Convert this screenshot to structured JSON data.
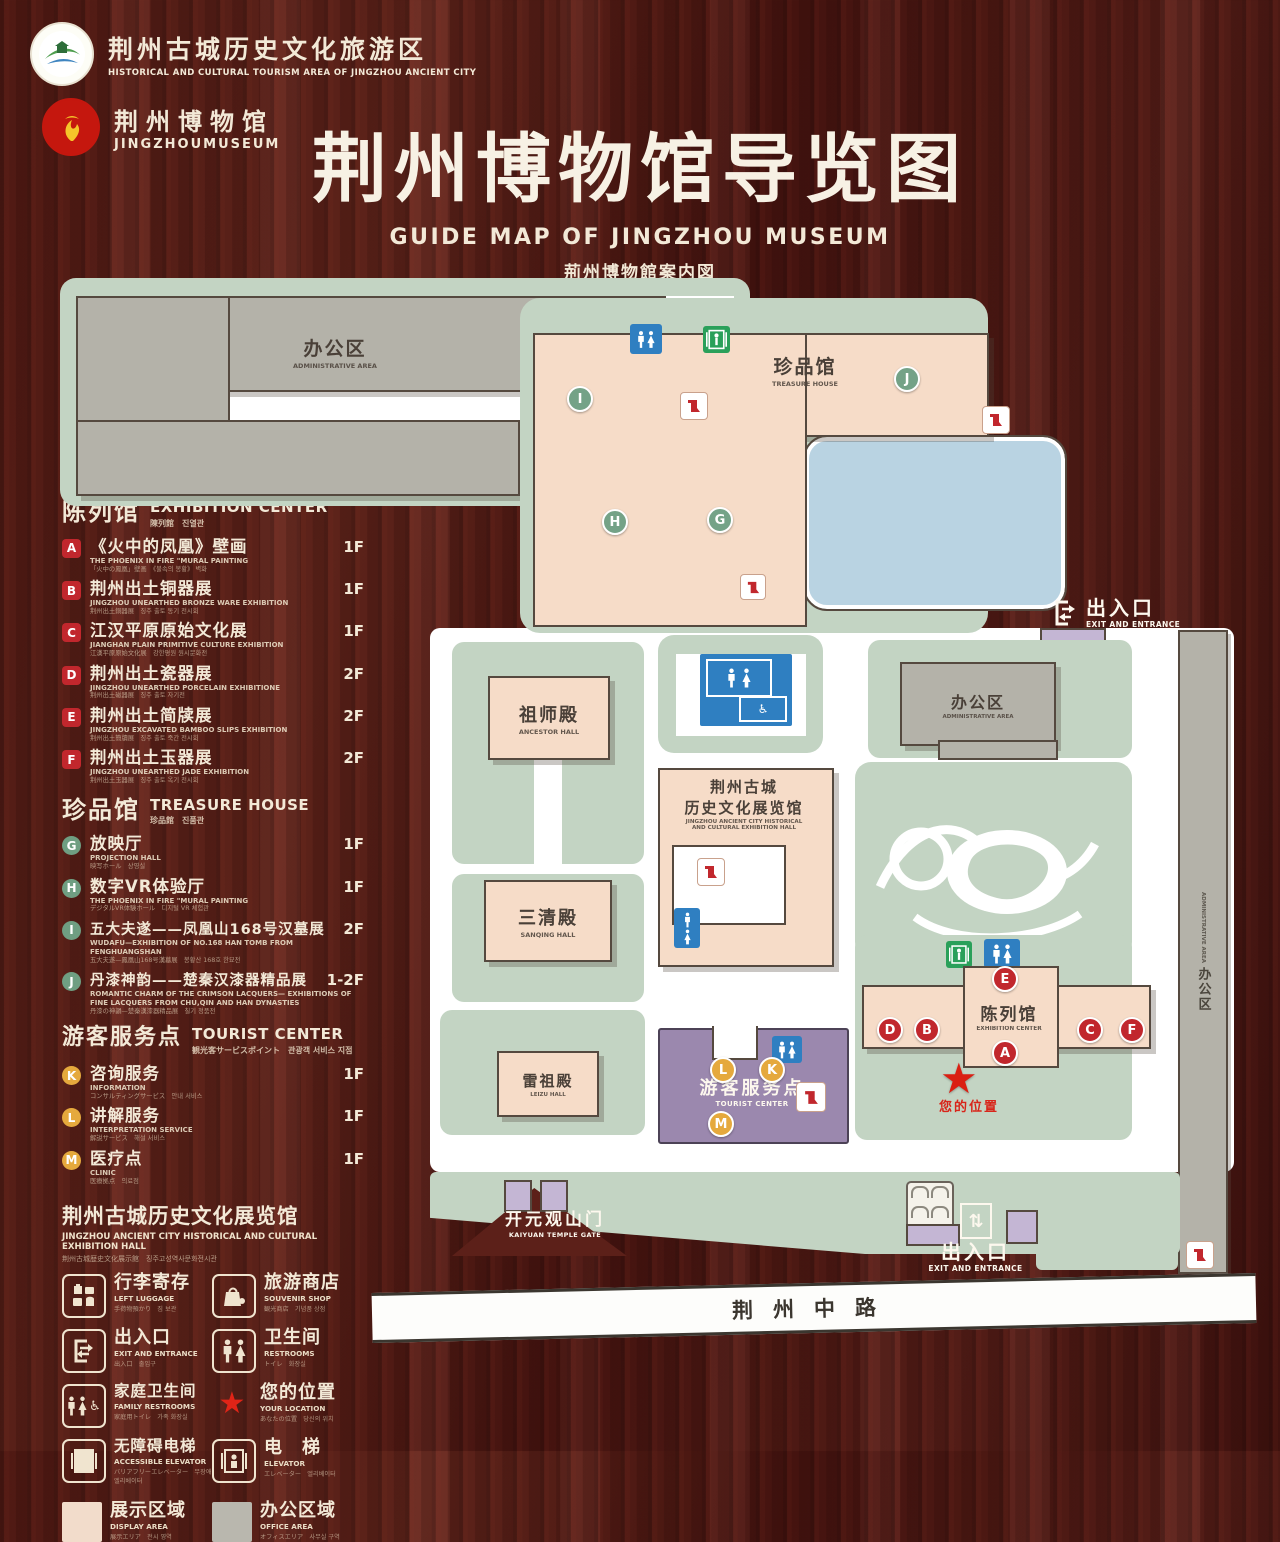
{
  "header": {
    "logo1": {
      "title": "荆州古城历史文化旅游区",
      "subtitle": "HISTORICAL AND CULTURAL TOURISM AREA OF JINGZHOU ANCIENT CITY"
    },
    "logo2": {
      "title": "荆州博物馆",
      "subtitle": "JINGZHOUMUSEUM"
    },
    "title": "荆州博物馆导览图",
    "subtitle_en": "GUIDE MAP OF JINGZHOU MUSEUM",
    "subtitle_ja": "荊州博物館案内図",
    "subtitle_ko": "징주박물관 안내도"
  },
  "legend": {
    "sections": [
      {
        "zh": "陈列馆",
        "en": "EXHIBITION CENTER",
        "sub": "陳列館　진열관",
        "items": [
          {
            "key": "A",
            "zh": "《火中的凤凰》壁画",
            "en": "THE PHOENIX IN FIRE \"MURAL PAINTING",
            "sub": "「火中の鳳凰」壁画　《불속의 봉황》 벽화",
            "floor": "1F"
          },
          {
            "key": "B",
            "zh": "荆州出土铜器展",
            "en": "JINGZHOU UNEARTHED BRONZE WARE EXHIBITION",
            "sub": "荆州出土銅器展　징주 출토 동기 전시회",
            "floor": "1F"
          },
          {
            "key": "C",
            "zh": "江汉平原原始文化展",
            "en": "JIANGHAN PLAIN PRIMITIVE CULTURE EXHIBITION",
            "sub": "江漢平原原始文化展　강한평원 원시문화전",
            "floor": "1F"
          },
          {
            "key": "D",
            "zh": "荆州出土瓷器展",
            "en": "JINGZHOU UNEARTHED PORCELAIN EXHIBITIONE",
            "sub": "荆州出土磁器展　징주 출토 자기전",
            "floor": "2F"
          },
          {
            "key": "E",
            "zh": "荆州出土简牍展",
            "en": "JINGZHOU EXCAVATED BAMBOO SLIPS EXHIBITION",
            "sub": "荆州出土簡牘展　징주 출토 죽간 전시회",
            "floor": "2F"
          },
          {
            "key": "F",
            "zh": "荆州出土玉器展",
            "en": "JINGZHOU UNEARTHED JADE EXHIBITION",
            "sub": "荆州出土玉器展　징주 출토 옥기 전시회",
            "floor": "2F"
          }
        ]
      },
      {
        "zh": "珍品馆",
        "en": "TREASURE HOUSE",
        "sub": "珍品館　진품관",
        "items": [
          {
            "key": "G",
            "zh": "放映厅",
            "en": "PROJECTION HALL",
            "sub": "映写ホール　상영실",
            "floor": "1F"
          },
          {
            "key": "H",
            "zh": "数字VR体验厅",
            "en": "THE PHOENIX IN FIRE \"MURAL PAINTING",
            "sub": "デジタルVR体験ホール　디지털 VR 체험관",
            "floor": "1F"
          },
          {
            "key": "I",
            "zh": "五大夫遂——凤凰山168号汉墓展",
            "en": "WUDAFU—EXHIBITION OF NO.168 HAN TOMB FROM FENGHUANGSHAN",
            "sub": "五大夫遂—鳳凰山168号漢墓展　봉황산 168호 한묘전",
            "floor": "2F"
          },
          {
            "key": "J",
            "zh": "丹漆神韵——楚秦汉漆器精品展",
            "en": "ROMANTIC CHARM OF THE CRIMSON LACQUERS— EXHIBITIONS OF FINE LACQUERS FROM CHU,QIN AND HAN DYNASTIES",
            "sub": "丹漆の神韻—楚秦漢漆器精品展　칠기 정품전",
            "floor": "1-2F"
          }
        ]
      },
      {
        "zh": "游客服务点",
        "en": "TOURIST CENTER",
        "sub": "観光客サービスポイント　관광객 서비스 지점",
        "items": [
          {
            "key": "K",
            "zh": "咨询服务",
            "en": "INFORMATION",
            "sub": "コンサルティングサービス　안내 서비스",
            "floor": "1F"
          },
          {
            "key": "L",
            "zh": "讲解服务",
            "en": "INTERPRETATION SERVICE",
            "sub": "解説サービス　해설 서비스",
            "floor": "1F"
          },
          {
            "key": "M",
            "zh": "医疗点",
            "en": "CLINIC",
            "sub": "医療拠点　의료점",
            "floor": "1F"
          }
        ]
      }
    ],
    "hall_heading": {
      "zh": "荆州古城历史文化展览馆",
      "en": "JINGZHOU ANCIENT CITY HISTORICAL AND CULTURAL EXHIBITION HALL",
      "sub": "荆州古城歴史文化展示館　징주고성역사문화전시관"
    },
    "pictos": [
      {
        "zh": "行李寄存",
        "en": "LEFT LUGGAGE",
        "sub": "手荷物預かり　짐 보관"
      },
      {
        "zh": "旅游商店",
        "en": "SOUVENIR SHOP",
        "sub": "観光商店　기념품 상점"
      },
      {
        "zh": "出入口",
        "en": "EXIT AND ENTRANCE",
        "sub": "出入口　출입구"
      },
      {
        "zh": "卫生间",
        "en": "RESTROOMS",
        "sub": "トイレ　화장실"
      },
      {
        "zh": "家庭卫生间",
        "en": "FAMILY RESTROOMS",
        "sub": "家庭用トイレ　가족 화장실"
      },
      {
        "zh": "您的位置",
        "en": "YOUR LOCATION",
        "sub": "あなたの位置　당신의 위치"
      },
      {
        "zh": "无障碍电梯",
        "en": "ACCESSIBLE ELEVATOR",
        "sub": "バリアフリーエレベーター　무장애 엘리베이터"
      },
      {
        "zh": "电　梯",
        "en": "ELEVATOR",
        "sub": "エレベーター　엘리베이터"
      },
      {
        "zh": "展示区域",
        "en": "DISPLAY AREA",
        "sub": "展示エリア　전시 영역"
      },
      {
        "zh": "办公区域",
        "en": "OFFICE AREA",
        "sub": "オフィスエリア　사무실 구역"
      }
    ]
  },
  "map": {
    "admin_top": {
      "zh": "办公区",
      "en": "ADMINISTRATIVE AREA"
    },
    "treasure_house": {
      "zh": "珍品馆",
      "en": "TREASURE HOUSE"
    },
    "ancestor_hall": {
      "zh": "祖师殿",
      "en": "ANCESTOR HALL"
    },
    "sanqing_hall": {
      "zh": "三清殿",
      "en": "SANQING HALL"
    },
    "leizu_hall": {
      "zh": "雷祖殿",
      "en": "LEIZU HALL"
    },
    "exhibition_hall": {
      "zh1": "荆州古城",
      "zh2": "历史文化展览馆",
      "en1": "JINGZHOU ANCIENT CITY HISTORICAL",
      "en2": "AND CULTURAL EXHIBITION HALL"
    },
    "admin_right": {
      "zh": "办公区",
      "en": "ADMINISTRATIVE AREA"
    },
    "admin_strip": {
      "zh": "办公区",
      "en": "ADMINISTRATIVE AREA"
    },
    "exhibition_center": {
      "zh": "陈列馆",
      "en": "EXHIBITION CENTER"
    },
    "tourist_center": {
      "zh": "游客服务点",
      "en": "TOURIST CENTER"
    },
    "your_location": {
      "zh": "您的位置"
    },
    "gate": {
      "zh": "开元观山门",
      "en": "KAIYUAN TEMPLE GATE"
    },
    "exit_ne": {
      "zh": "出入口",
      "en": "EXIT AND ENTRANCE"
    },
    "exit_s": {
      "zh": "出入口",
      "en": "EXIT AND ENTRANCE"
    },
    "road": {
      "zh": "荆州中路"
    },
    "markers": {
      "a": "A",
      "b": "B",
      "c": "C",
      "d": "D",
      "e": "E",
      "f": "F",
      "g": "G",
      "h": "H",
      "i": "I",
      "j": "J",
      "k": "K",
      "l": "L",
      "m": "M"
    }
  },
  "glyphs": {
    "star": "★",
    "wheelchair": "♿",
    "updown": "⇅",
    "leftright": "⇄"
  },
  "colors": {
    "wood_bg": "#5a1d16",
    "green_area": "#c3d4c3",
    "pink_area": "#f6dcc8",
    "office_gray": "#b4b2a9",
    "pond_blue": "#b9d3e2",
    "purple_area": "#9b88ae",
    "marker_red": "#c1272d",
    "marker_green": "#74a287",
    "marker_orange": "#e5a93d",
    "restroom_blue": "#2f7fc1",
    "elevator_green": "#2aa05a",
    "location_red": "#da1f12"
  }
}
